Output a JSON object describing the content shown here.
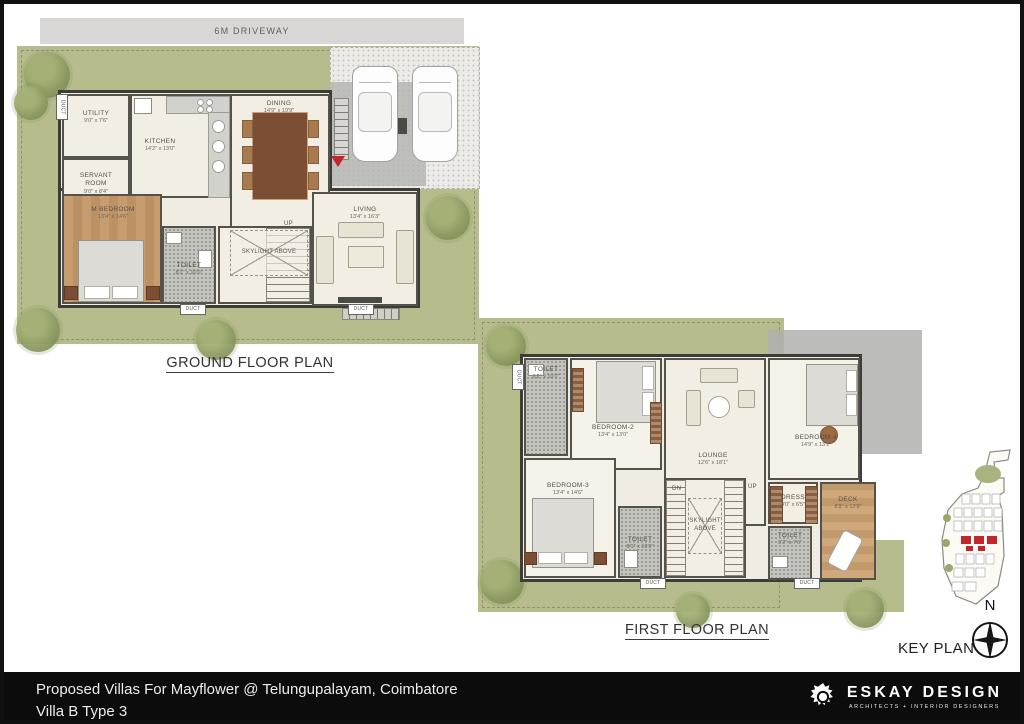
{
  "header": {
    "driveway_label": "6M DRIVEWAY"
  },
  "ground_floor": {
    "title": "GROUND FLOOR PLAN",
    "rooms": {
      "utility": {
        "name": "UTILITY",
        "dim": "9'0\" x 7'6\""
      },
      "servant": {
        "name": "SERVANT ROOM",
        "dim": "9'0\" x 8'4\""
      },
      "kitchen": {
        "name": "KITCHEN",
        "dim": "14'2\" x 13'0\""
      },
      "dining": {
        "name": "DINING",
        "dim": "14'9\" x 19'9\""
      },
      "m_bedroom": {
        "name": "M BEDROOM",
        "dim": "13'4\" x 14'6\""
      },
      "toilet": {
        "name": "TOILET",
        "dim": "8'1\" x 10'0\""
      },
      "skylight": {
        "name": "SKYLIGHT ABOVE"
      },
      "living": {
        "name": "LIVING",
        "dim": "13'4\" x 16'3\""
      }
    },
    "annotations": {
      "up": "UP",
      "duct": "DUCT"
    }
  },
  "first_floor": {
    "title": "FIRST FLOOR PLAN",
    "rooms": {
      "toilet2": {
        "name": "TOILET",
        "dim": "6'2\" x 10'0\""
      },
      "bedroom2": {
        "name": "BEDROOM-2",
        "dim": "13'4\" x 13'0\""
      },
      "lounge": {
        "name": "LOUNGE",
        "dim": "12'6\" x 18'1\""
      },
      "bedroom4": {
        "name": "BEDROOM-4",
        "dim": "14'9\" x 13'1\""
      },
      "bedroom3": {
        "name": "BEDROOM-3",
        "dim": "13'4\" x 14'6\""
      },
      "toilet3": {
        "name": "TOILET",
        "dim": "8'1\" x 10'0\""
      },
      "skylight": {
        "name": "SKYLIGHT ABOVE"
      },
      "dress": {
        "name": "DRESS",
        "dim": "8'0\" x 6'5\""
      },
      "toilet4": {
        "name": "TOILET",
        "dim": "9'2\" x 7'6\""
      },
      "deck": {
        "name": "DECK",
        "dim": "8'9\" x 12'9\""
      }
    },
    "annotations": {
      "up": "UP",
      "dn": "DN",
      "duct": "DUCT"
    }
  },
  "key_plan": {
    "label": "KEY PLAN",
    "north_label": "N"
  },
  "footer": {
    "project_line1": "Proposed Villas For Mayflower @ Telungupalayam, Coimbatore",
    "project_line2": "Villa B Type 3",
    "brand_name": "ESKAY DESIGN",
    "brand_tagline": "ARCHITECTS  +  INTERIOR DESIGNERS"
  },
  "colors": {
    "accent_red": "#c0272b",
    "lawn_green": "#b6bc8c",
    "wall": "#3e3c38",
    "floor_cream": "#f1ece1",
    "wood": "#c79d70",
    "footer_bg": "#0c0c0c"
  }
}
